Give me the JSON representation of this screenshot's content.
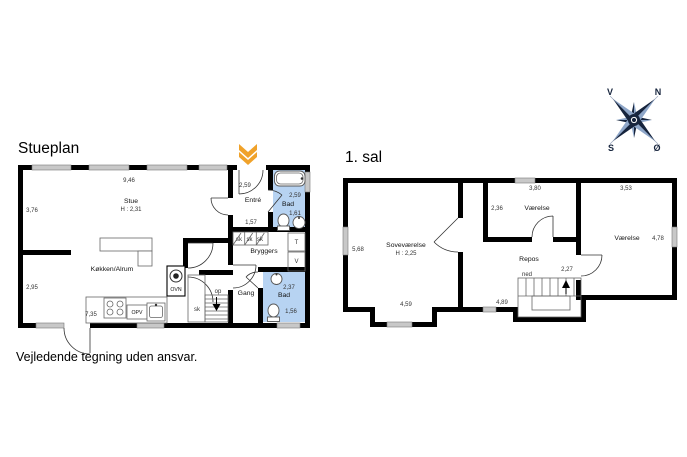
{
  "titles": {
    "ground": "Stueplan",
    "first": "1. sal"
  },
  "disclaimer": "Vejledende tegning uden ansvar.",
  "compass": {
    "nw": "V",
    "ne": "N",
    "sw": "S",
    "se": "Ø"
  },
  "colors": {
    "wall": "#000000",
    "window_gray": "#c8c8c8",
    "bathroom_blue": "#b7d3f2",
    "entrance_marker_orange": "#f0a22a",
    "compass_navy": "#16243d"
  },
  "stueplan": {
    "stue": {
      "name": "Stue",
      "ceiling": "H : 2,31",
      "dim_top": "9,46",
      "dim_left": "3,76"
    },
    "entre": {
      "name": "Entré",
      "dim_top": "2,59",
      "dim_bottom": "1,57"
    },
    "bad_top": {
      "name": "Bad",
      "dim1": "2,59",
      "dim2": "1,61"
    },
    "bryggers": {
      "name": "Bryggers"
    },
    "closets": {
      "sk1": "sk",
      "sk2": "sk",
      "sk3": "sk",
      "hall_sk": "sk",
      "t": "T",
      "v": "V"
    },
    "koekken": {
      "name": "Køkken/Alrum",
      "dim_left": "2,95",
      "dim_bottom": "7,35",
      "ovn": "OVN",
      "opv": "OPV"
    },
    "gang": {
      "name": "Gang"
    },
    "stairs": {
      "dir": "op"
    },
    "bad_bottom": {
      "name": "Bad",
      "dim1": "2,37",
      "dim2": "1,56"
    }
  },
  "first_floor": {
    "sovevaerelse": {
      "name": "Soveværelse",
      "ceiling": "H : 2,25",
      "dim_left": "5,68",
      "dim_bottom": "4,59"
    },
    "vaerelse_mid": {
      "name": "Værelse",
      "dim_top": "3,80",
      "dim_left": "2,36"
    },
    "vaerelse_right": {
      "name": "Værelse",
      "dim_top": "3,53",
      "dim_right": "4,78"
    },
    "repos": {
      "name": "Repos",
      "dim": "4,89"
    },
    "stairs": {
      "dir": "ned",
      "dim": "2,27"
    }
  }
}
